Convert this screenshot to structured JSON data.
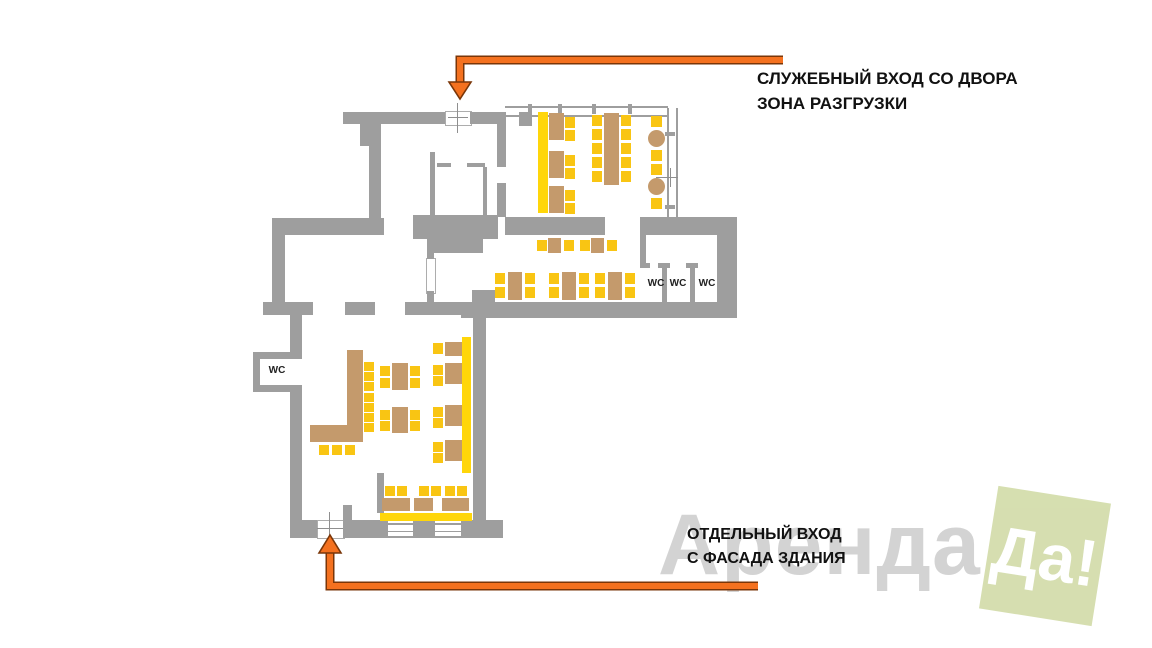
{
  "labels": {
    "service_entrance": {
      "line1": "СЛУЖЕБНЫЙ ВХОД СО ДВОРА",
      "line2": "ЗОНА РАЗГРУЗКИ"
    },
    "separate_entrance": {
      "line1": "ОТДЕЛЬНЫЙ ВХОД",
      "line2": "С ФАСАДА ЗДАНИЯ"
    }
  },
  "wc": [
    "WC",
    "WC",
    "WC",
    "WC"
  ],
  "watermark": {
    "text": "Аренда",
    "badge": "Да!"
  },
  "colors": {
    "wall": "#9e9e9e",
    "seat": "#f9c513",
    "banquette": "#ffd60a",
    "wood": "#c49a6c",
    "arrow": "#f4711f",
    "arrow_outline": "#7a3608",
    "label_text": "#111111",
    "watermark_text": "#c9c9c9",
    "watermark_badge_bg": "#d4ddac",
    "watermark_badge_text": "#ffffff"
  },
  "plan": {
    "walls": [
      [
        343,
        112,
        102,
        12
      ],
      [
        470,
        112,
        30,
        12
      ],
      [
        360,
        112,
        21,
        34
      ],
      [
        369,
        146,
        12,
        72
      ],
      [
        272,
        218,
        112,
        17
      ],
      [
        272,
        235,
        13,
        67
      ],
      [
        263,
        302,
        50,
        13
      ],
      [
        290,
        315,
        12,
        44
      ],
      [
        290,
        385,
        12,
        153
      ],
      [
        290,
        520,
        27,
        18
      ],
      [
        343,
        520,
        45,
        18
      ],
      [
        413,
        520,
        22,
        18
      ],
      [
        461,
        520,
        42,
        18
      ],
      [
        473,
        318,
        13,
        207
      ],
      [
        343,
        505,
        9,
        15
      ],
      [
        377,
        473,
        7,
        40
      ],
      [
        461,
        302,
        276,
        16
      ],
      [
        472,
        290,
        23,
        12
      ],
      [
        413,
        215,
        85,
        24
      ],
      [
        427,
        239,
        56,
        14
      ],
      [
        427,
        253,
        7,
        6
      ],
      [
        427,
        291,
        7,
        11
      ],
      [
        345,
        302,
        30,
        13
      ],
      [
        405,
        302,
        30,
        13
      ],
      [
        435,
        302,
        26,
        13
      ],
      [
        505,
        217,
        100,
        18
      ],
      [
        640,
        217,
        97,
        18
      ],
      [
        497,
        112,
        9,
        55
      ],
      [
        497,
        183,
        9,
        34
      ],
      [
        519,
        112,
        13,
        14
      ],
      [
        430,
        152,
        5,
        63
      ],
      [
        437,
        163,
        14,
        4
      ],
      [
        467,
        163,
        18,
        4
      ],
      [
        483,
        167,
        4,
        48
      ],
      [
        640,
        235,
        6,
        33
      ],
      [
        640,
        263,
        10,
        5
      ],
      [
        658,
        263,
        12,
        5
      ],
      [
        662,
        268,
        5,
        34
      ],
      [
        686,
        263,
        12,
        5
      ],
      [
        690,
        268,
        5,
        34
      ],
      [
        717,
        235,
        20,
        67
      ],
      [
        253,
        352,
        48,
        7
      ],
      [
        253,
        352,
        7,
        40
      ],
      [
        253,
        385,
        48,
        7
      ]
    ],
    "banquettes": [
      [
        538,
        112,
        10,
        101
      ],
      [
        462,
        337,
        9,
        136
      ],
      [
        380,
        513,
        92,
        8
      ]
    ],
    "bar": [
      [
        347,
        350,
        16,
        77
      ],
      [
        310,
        425,
        53,
        17
      ]
    ],
    "tables": [
      [
        549,
        113,
        15,
        27
      ],
      [
        549,
        151,
        15,
        27
      ],
      [
        549,
        186,
        15,
        27
      ],
      [
        604,
        113,
        15,
        72
      ],
      [
        548,
        238,
        13,
        15
      ],
      [
        591,
        238,
        13,
        15
      ],
      [
        508,
        272,
        14,
        28
      ],
      [
        562,
        272,
        14,
        28
      ],
      [
        608,
        272,
        14,
        28
      ],
      [
        392,
        363,
        16,
        27
      ],
      [
        392,
        407,
        16,
        26
      ],
      [
        445,
        342,
        17,
        14
      ],
      [
        445,
        363,
        17,
        21
      ],
      [
        445,
        405,
        17,
        21
      ],
      [
        445,
        440,
        17,
        21
      ],
      [
        382,
        498,
        28,
        13
      ],
      [
        414,
        498,
        19,
        13
      ],
      [
        442,
        498,
        27,
        13
      ]
    ],
    "round_tables": [
      [
        648,
        130,
        17,
        17
      ],
      [
        648,
        178,
        17,
        17
      ]
    ],
    "chairs": [
      [
        565,
        117,
        10,
        11
      ],
      [
        565,
        130,
        10,
        11
      ],
      [
        565,
        155,
        10,
        11
      ],
      [
        565,
        168,
        10,
        11
      ],
      [
        565,
        190,
        10,
        11
      ],
      [
        565,
        203,
        10,
        11
      ],
      [
        592,
        115,
        10,
        11
      ],
      [
        592,
        129,
        10,
        11
      ],
      [
        592,
        143,
        10,
        11
      ],
      [
        592,
        157,
        10,
        11
      ],
      [
        592,
        171,
        10,
        11
      ],
      [
        621,
        115,
        10,
        11
      ],
      [
        621,
        129,
        10,
        11
      ],
      [
        621,
        143,
        10,
        11
      ],
      [
        621,
        157,
        10,
        11
      ],
      [
        621,
        171,
        10,
        11
      ],
      [
        651,
        116,
        11,
        11
      ],
      [
        651,
        150,
        11,
        11
      ],
      [
        651,
        164,
        11,
        11
      ],
      [
        651,
        198,
        11,
        11
      ],
      [
        537,
        240,
        10,
        11
      ],
      [
        564,
        240,
        10,
        11
      ],
      [
        580,
        240,
        10,
        11
      ],
      [
        607,
        240,
        10,
        11
      ],
      [
        495,
        273,
        10,
        11
      ],
      [
        495,
        287,
        10,
        11
      ],
      [
        525,
        273,
        10,
        11
      ],
      [
        525,
        287,
        10,
        11
      ],
      [
        549,
        273,
        10,
        11
      ],
      [
        549,
        287,
        10,
        11
      ],
      [
        579,
        273,
        10,
        11
      ],
      [
        579,
        287,
        10,
        11
      ],
      [
        595,
        273,
        10,
        11
      ],
      [
        595,
        287,
        10,
        11
      ],
      [
        625,
        273,
        10,
        11
      ],
      [
        625,
        287,
        10,
        11
      ],
      [
        380,
        366,
        10,
        10
      ],
      [
        380,
        378,
        10,
        10
      ],
      [
        410,
        366,
        10,
        10
      ],
      [
        410,
        378,
        10,
        10
      ],
      [
        380,
        410,
        10,
        10
      ],
      [
        380,
        421,
        10,
        10
      ],
      [
        410,
        410,
        10,
        10
      ],
      [
        410,
        421,
        10,
        10
      ],
      [
        433,
        343,
        10,
        11
      ],
      [
        433,
        365,
        10,
        10
      ],
      [
        433,
        376,
        10,
        10
      ],
      [
        433,
        407,
        10,
        10
      ],
      [
        433,
        418,
        10,
        10
      ],
      [
        433,
        442,
        10,
        10
      ],
      [
        433,
        453,
        10,
        10
      ],
      [
        385,
        486,
        10,
        10
      ],
      [
        397,
        486,
        10,
        10
      ],
      [
        419,
        486,
        10,
        10
      ],
      [
        431,
        486,
        10,
        10
      ],
      [
        445,
        486,
        10,
        10
      ],
      [
        457,
        486,
        10,
        10
      ]
    ],
    "stools": [
      [
        319,
        445,
        10,
        10
      ],
      [
        332,
        445,
        10,
        10
      ],
      [
        345,
        445,
        10,
        10
      ],
      [
        364,
        362,
        10,
        9
      ],
      [
        364,
        372,
        10,
        9
      ],
      [
        364,
        382,
        10,
        9
      ],
      [
        364,
        393,
        10,
        9
      ],
      [
        364,
        403,
        10,
        9
      ],
      [
        364,
        413,
        10,
        9
      ],
      [
        364,
        423,
        10,
        9
      ]
    ]
  }
}
